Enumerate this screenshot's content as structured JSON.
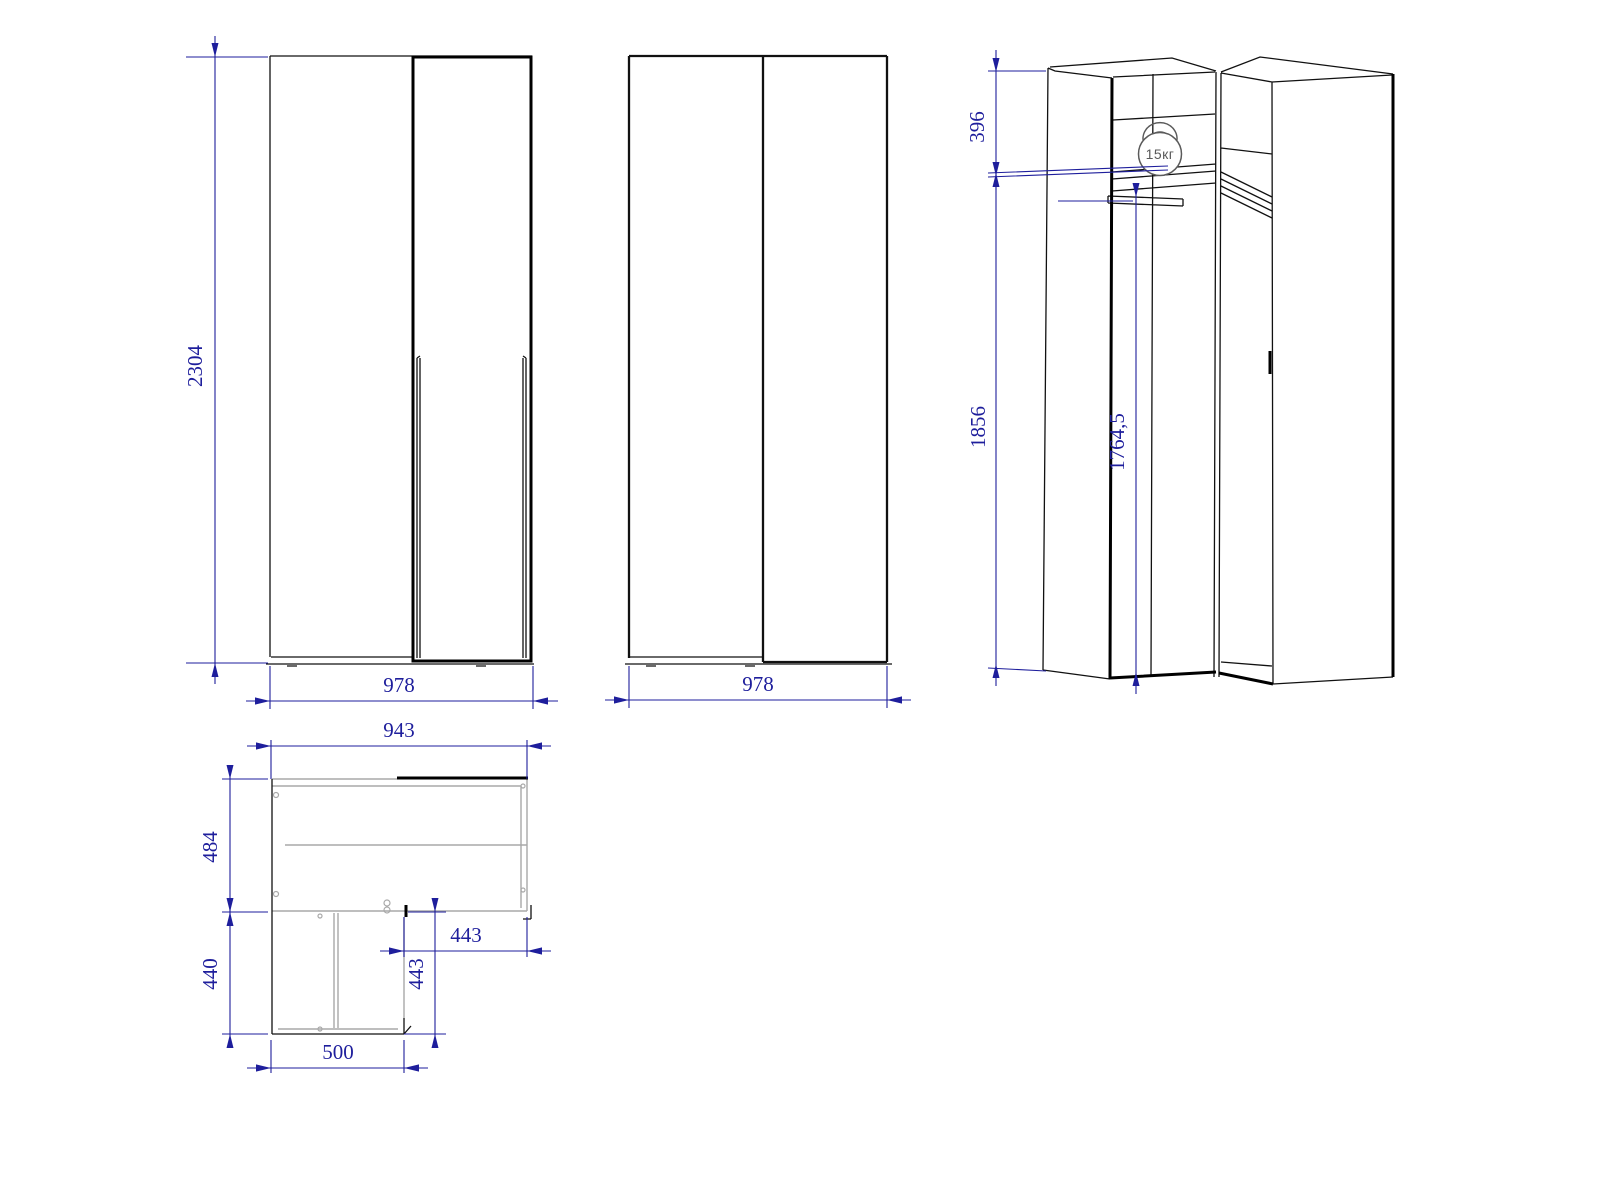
{
  "drawing": {
    "type": "furniture-technical-drawing",
    "subject": "corner wardrobe",
    "colors": {
      "dimension_blue": "#1e1e9c",
      "drawing_black": "#111111",
      "panel_gray": "#a9a9a9",
      "badge_gray": "#5a5a5a"
    }
  },
  "dims": {
    "front_height": "2304",
    "front_width": "978",
    "back_width": "978",
    "plan_width": "943",
    "plan_depth": "484",
    "plan_leg_depth": "440",
    "plan_leg_width": "500",
    "plan_corner_depth": "443",
    "plan_inner_depth": "443",
    "iso_top_section": "396",
    "iso_interior_height": "1856",
    "iso_rod_height": "1764,5"
  },
  "iso": {
    "weight_badge": "15кг"
  }
}
